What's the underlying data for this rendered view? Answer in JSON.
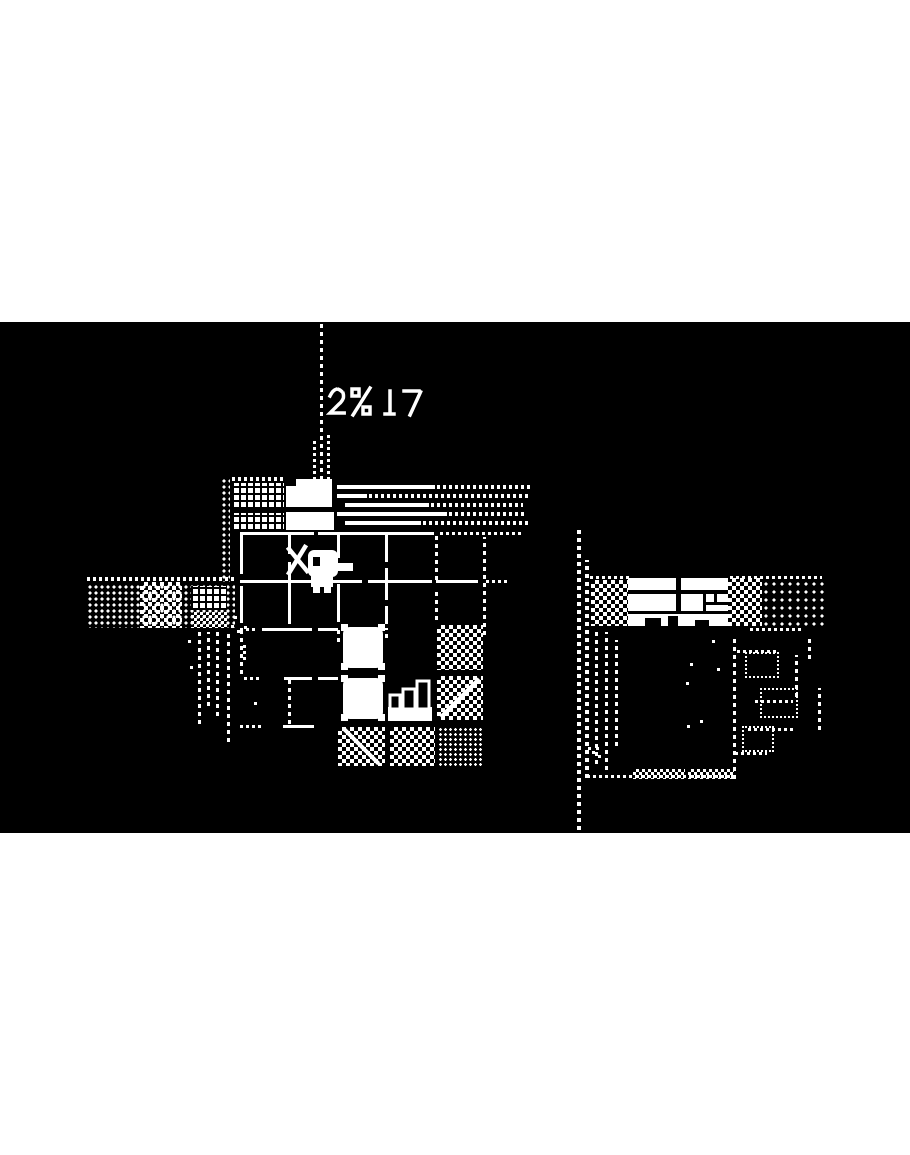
{
  "theme": {
    "game-bg": "#000000",
    "ink": "#ffffff",
    "letterbox": "#ffffff"
  },
  "entities": {
    "viewport": "1-bit dithered overhead game scene, letterboxed",
    "letterbox": "white letterbox bar",
    "pole": "tall dashed flag pole",
    "smoke": "dithered glyph puffs beside pole",
    "hotel": "building with lattice windows and dotted west wall",
    "hotel_door": "white doorway block",
    "awning": "horizontal awning rails fading into dots",
    "rooms": "grid of rooms with door gaps, east walls faded to dots",
    "wall": "room wall segment",
    "player": "duck hero with sword",
    "bed": "white bed tile with corner posts",
    "stairs": "staircase tile",
    "checker_tile": "dithered checker floor tile",
    "rug": "dithered rug tile",
    "west_path": "dithered path and lattice bridge heading west",
    "waterfall": "dotted waterfall columns below path",
    "camper": "long white building with windows flanked by dithered blocks",
    "camper_windows": "window panes of long building",
    "ruins": "faded dotted room outlines",
    "shore": "dotted shoreline with wave dithering",
    "stray": "scattered single pixels"
  }
}
